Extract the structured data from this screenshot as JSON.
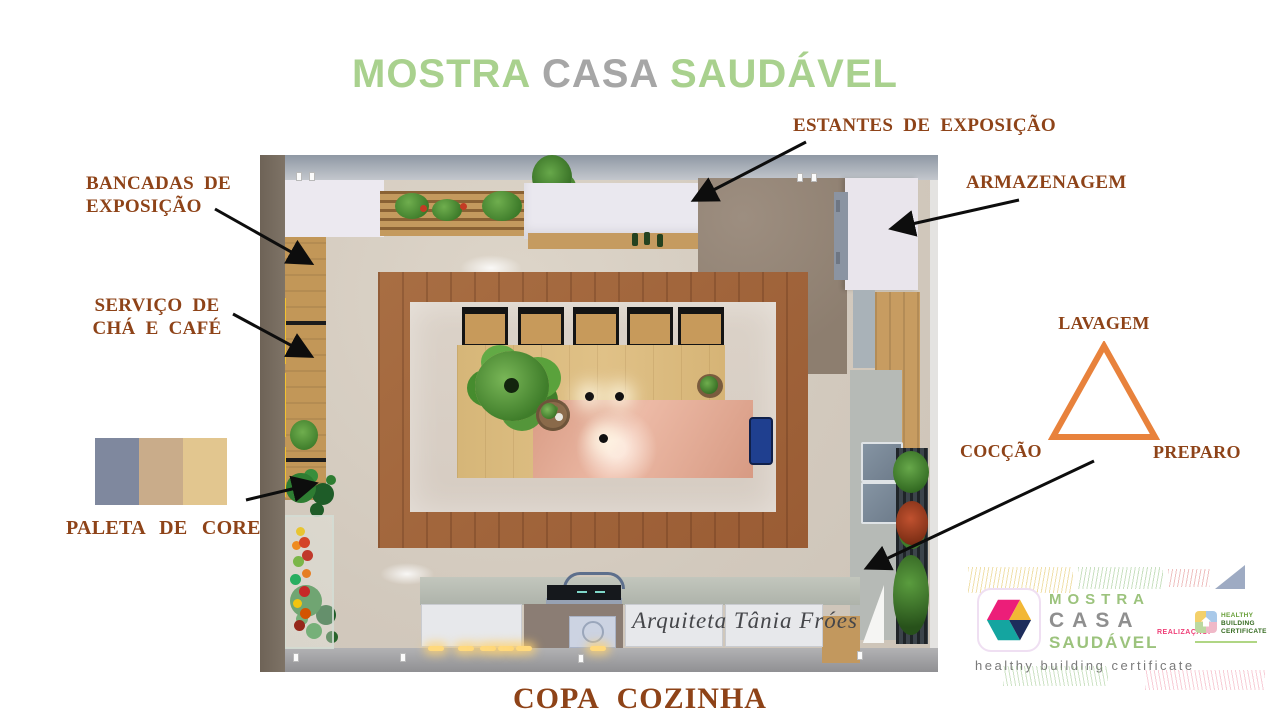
{
  "title": {
    "word1": "MOSTRA",
    "word2": "CASA",
    "word3": "SAUDÁVEL"
  },
  "colors": {
    "title_green": "#a9d18e",
    "title_gray": "#a6a6a6",
    "label_brown": "#8e4318",
    "triangle_orange": "#e8823c",
    "arrow_black": "#0d0d0d"
  },
  "annotations": {
    "estantes": "ESTANTES DE EXPOSIÇÃO",
    "bancadas_line1": "BANCADAS DE",
    "bancadas_line2": "EXPOSIÇÃO",
    "armazenagem": "ARMAZENAGEM",
    "servico_line1": "SERVIÇO DE",
    "servico_line2": "CHÁ E CAFÉ",
    "paleta": "PALETA DE CORES"
  },
  "work_triangle": {
    "top": "LAVAGEM",
    "bottom_left": "COCÇÃO",
    "bottom_right": "PREPARO"
  },
  "palette": {
    "swatch1": "#7F889E",
    "swatch2": "#C9AC8A",
    "swatch3": "#E2C68F"
  },
  "render": {
    "watermark": "Arquiteta Tânia Fróes"
  },
  "caption": "COPA COZINHA",
  "logo": {
    "line1": "MOSTRA",
    "line2": "CASA",
    "line3": "SAUDÁVEL",
    "tagline": "healthy building certificate",
    "realizacao": "REALIZAÇÃO:",
    "partner_line1": "HEALTHY",
    "partner_line2": "BUILDING",
    "partner_line3": "CERTIFICATE"
  }
}
